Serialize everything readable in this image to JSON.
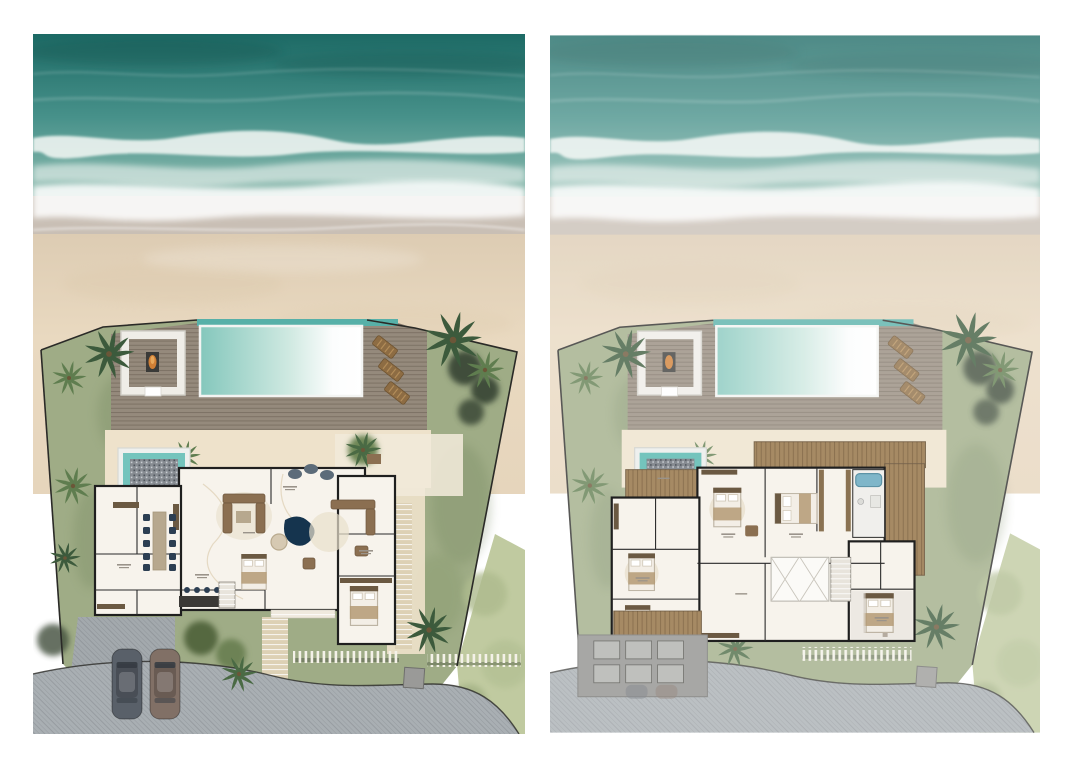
{
  "figure": {
    "kind": "beachfront-villa-site-plans",
    "panel_count": 2,
    "visible_text": "none (room labels are sub-legible micro-annotations)"
  },
  "palette": {
    "ocean_deep": "#1d6a65",
    "ocean_mid": "#47918a",
    "ocean_shallow": "#7fb3a8",
    "foam": "#eef4f1",
    "wet_sand": "#c9bfb5",
    "sand": "#e9d9c0",
    "sand_shadow": "#d8c4a4",
    "deck_wood": "#958a7c",
    "deck_line": "#7d7266",
    "platform_white": "#efede7",
    "pool_edge": "#57b0a8",
    "pool_left": "#84c7bc",
    "pool_mid": "#cfe9e1",
    "pool_right": "#fcfdfd",
    "fire_orange": "#d07f35",
    "lounger_wood": "#8d6c43",
    "lawn": "#9fac86",
    "lawn_dark": "#74875f",
    "hedge": "#3f4e3a",
    "shrub_light": "#c0caa0",
    "patio_sand": "#eee2cb",
    "stone_path": "#ddd1b5",
    "road": "#a9afb3",
    "driveway": "#a3a9ad",
    "floor": "#f7f3ec",
    "floor_gray": "#e6e3dd",
    "wall": "#1f1f1f",
    "vein": "#d9c8a9",
    "wood_dark": "#6b5942",
    "terrace_wood": "#a68a64",
    "sofa_brown": "#8b6f51",
    "table_wood": "#b7a88e",
    "chair_navy": "#2c3e52",
    "pond_navy": "#15344e",
    "rug_beige": "#e8dfcc",
    "bed_white": "#f3eee6",
    "bed_throw": "#b49a74",
    "spa_teal": "#74c4bd",
    "mosaic_gray": "#868b91",
    "tub_blue": "#7fb6c9",
    "car_gray": "#596069",
    "car_brown": "#817066",
    "roof_gray": "#a7a7a5",
    "skylight_gray": "#bfc0bd",
    "boundary": "#2a2a27",
    "gate_gray": "#9a9a98",
    "page_bg": "#ffffff"
  },
  "panels": [
    {
      "id": "ground-floor",
      "side": "left",
      "features": [
        "ocean-with-surf",
        "beach",
        "fan-shaped-site-boundary",
        "pool-deck",
        "infinity-pool",
        "fire-pit-lounge-platform",
        "sun-loungers",
        "mosaic-plunge-pool",
        "open-plan-villa",
        "dining-table",
        "kitchen-island",
        "two-sofa-groups",
        "water-feature-pond",
        "two-bedrooms",
        "driveway-with-two-cars",
        "garden-trees",
        "stone-entry-paths",
        "slat-screens",
        "entry-gate",
        "access-road",
        "palm-trees"
      ],
      "counts": {
        "sun_loungers": 3,
        "dining_chairs": 10,
        "bar_stools": 4,
        "cars": 2,
        "beds": 2
      }
    },
    {
      "id": "upper-floor",
      "side": "right",
      "appearance": "same site rendered lighter/faded",
      "features": [
        "ocean-with-surf",
        "beach",
        "fan-shaped-site-boundary",
        "pool-deck",
        "infinity-pool",
        "fire-pit-lounge-platform",
        "sun-loungers",
        "mosaic-plunge-pool",
        "wood-roof-terraces",
        "bedroom-suites",
        "walk-in-closet",
        "bathroom-with-tub",
        "stair-void",
        "garage-flat-roof-with-skylights",
        "slat-screen",
        "entry-gate",
        "access-road",
        "palm-trees"
      ],
      "counts": {
        "sun_loungers": 3,
        "beds": 5,
        "skylights": 6
      }
    }
  ]
}
